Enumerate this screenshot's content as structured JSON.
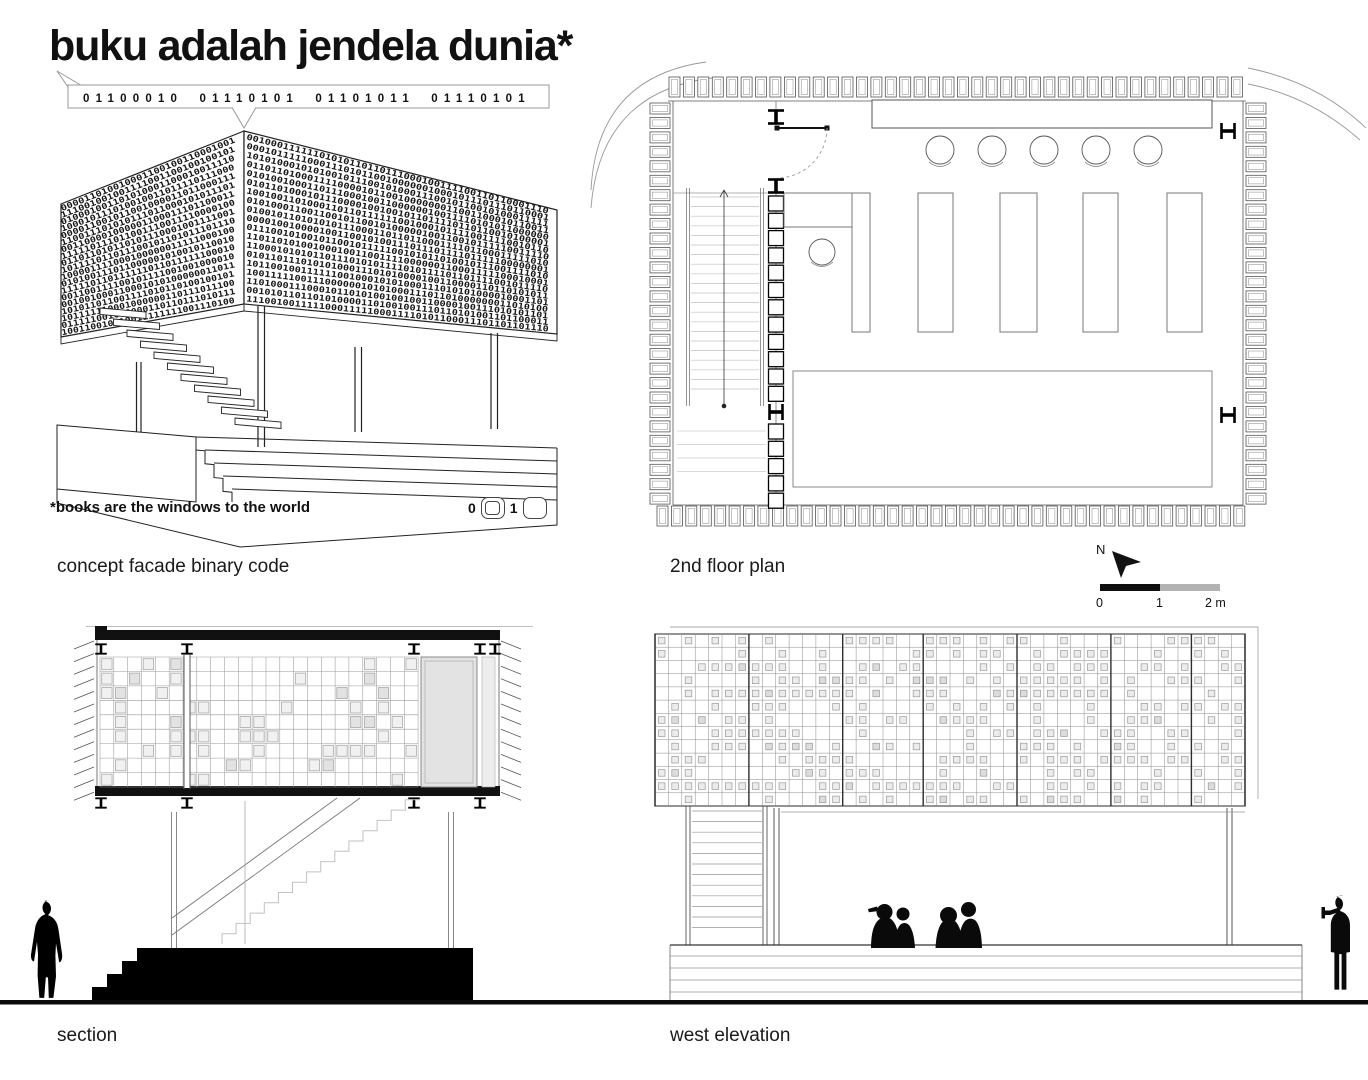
{
  "sheet": {
    "title": "buku adalah jendela dunia*",
    "binary_string": "01100010 01110101 01101011 01110101",
    "footnote": "*books are the windows to the world",
    "legend": {
      "zero_label": "0",
      "one_label": "1"
    },
    "labels": {
      "concept": "concept facade binary code",
      "plan": "2nd floor plan",
      "section": "section",
      "elevation": "west elevation"
    },
    "north": {
      "label": "N"
    },
    "scale_bar": {
      "tick0": "0",
      "tick1": "1",
      "tick2": "2 m"
    }
  },
  "colors": {
    "ink": "#111111",
    "line_dark": "#333333",
    "line_mid": "#888888",
    "line_light": "#c6c6c6",
    "gray_fill": "#e4e4e4",
    "scale_black": "#0f0f0f",
    "scale_gray": "#b3b3b3"
  },
  "drawing": {
    "axon_faces": [
      {
        "target": "axon-face-left-digits",
        "x0": 62,
        "y0top": 207,
        "y0bot": 338,
        "x1": 243,
        "y1top": 134,
        "y1bot": 305,
        "rows": 19,
        "chars": 30,
        "seed": 11
      },
      {
        "target": "axon-face-right-digits",
        "x0": 246,
        "y0top": 134,
        "y0bot": 305,
        "x1": 556,
        "y1top": 212,
        "y1bot": 335,
        "rows": 19,
        "chars": 50,
        "seed": 22
      }
    ],
    "axon_treads": {
      "count": 11,
      "x0": 100,
      "y0": 308,
      "dx": 13.5,
      "dy": 11
    },
    "plan": {
      "wall_runs": [
        {
          "x": 669,
          "y": 77,
          "dx": 14.42,
          "dy": 0,
          "count": 40,
          "w": 11,
          "h": 20
        },
        {
          "x": 657,
          "y": 506,
          "dx": 14.42,
          "dy": 0,
          "count": 41,
          "w": 11,
          "h": 20
        },
        {
          "x": 650,
          "y": 103,
          "dx": 0,
          "dy": 14.45,
          "count": 28,
          "w": 20,
          "h": 11
        },
        {
          "x": 1246,
          "y": 103,
          "dx": 0,
          "dy": 14.45,
          "count": 28,
          "w": 20,
          "h": 11
        }
      ],
      "stack": {
        "x": 768.5,
        "w": 15,
        "h": 15,
        "runs": [
          {
            "y0": 196,
            "step": 17.3,
            "count": 12
          },
          {
            "y0": 424,
            "step": 17.3,
            "count": 5
          }
        ]
      },
      "stair": {
        "rail_xs": [
          686.5,
          689.5,
          760.5,
          763.5
        ],
        "y0": 188,
        "y1": 406,
        "tread_y0": 197,
        "tread_step": 9.6,
        "tread_count": 21,
        "tread_x0": 691,
        "tread_x1": 759,
        "center_x": 724,
        "landing": {
          "y0": 431,
          "step": 13.5,
          "count": 4,
          "x0": 677,
          "x1": 766
        }
      },
      "chairs": {
        "cxs": [
          940,
          992,
          1044,
          1096,
          1148
        ],
        "cy": 150,
        "r": 14
      },
      "shelves": [
        [
          852,
          18
        ],
        [
          918,
          35
        ],
        [
          1000,
          37
        ],
        [
          1083,
          35
        ],
        [
          1167,
          35
        ]
      ],
      "shelf_y": 193,
      "shelf_h": 139,
      "ibeams": [
        [
          776,
          117,
          0
        ],
        [
          776,
          186,
          0
        ],
        [
          776,
          412,
          90
        ],
        [
          1228,
          131,
          90
        ],
        [
          1228,
          415,
          90
        ]
      ]
    },
    "section": {
      "grid": {
        "x0": 100,
        "y0": 657,
        "cols": 23,
        "rows": 9,
        "cw": 13.83,
        "rh": 14.44,
        "book_p": 0.24,
        "seed": 7
      },
      "ibeams_top": {
        "xs": [
          101,
          187,
          414,
          480,
          495
        ],
        "y": 649
      },
      "ibeams_bot": {
        "xs": [
          101,
          187,
          414,
          480
        ],
        "y": 803
      },
      "hatch": {
        "count": 13,
        "step": 12.6
      },
      "stair": {
        "x0": 222,
        "y0": 944,
        "steps": 14,
        "run": 14.1,
        "rise": 10.3
      }
    },
    "elevation": {
      "grid": {
        "x0": 655,
        "y0": 634,
        "cols": 44,
        "rows": 13,
        "cw": 13.409,
        "rh": 13.23,
        "hole_p": 0.46,
        "seed": 99,
        "mullion_cols": [
          0,
          7,
          14,
          20,
          27,
          34,
          40,
          44
        ]
      },
      "stair": {
        "tread_y0": 811,
        "tread_step": 10.6,
        "tread_count": 12,
        "x0": 692,
        "x1": 762,
        "side_xs": [
          686,
          690,
          763,
          767
        ],
        "y_top": 806,
        "y_bot": 945
      },
      "plinth": {
        "x0": 670,
        "x1": 1302,
        "y_top": 945,
        "lines": [
          956,
          968,
          980,
          992
        ]
      }
    }
  }
}
